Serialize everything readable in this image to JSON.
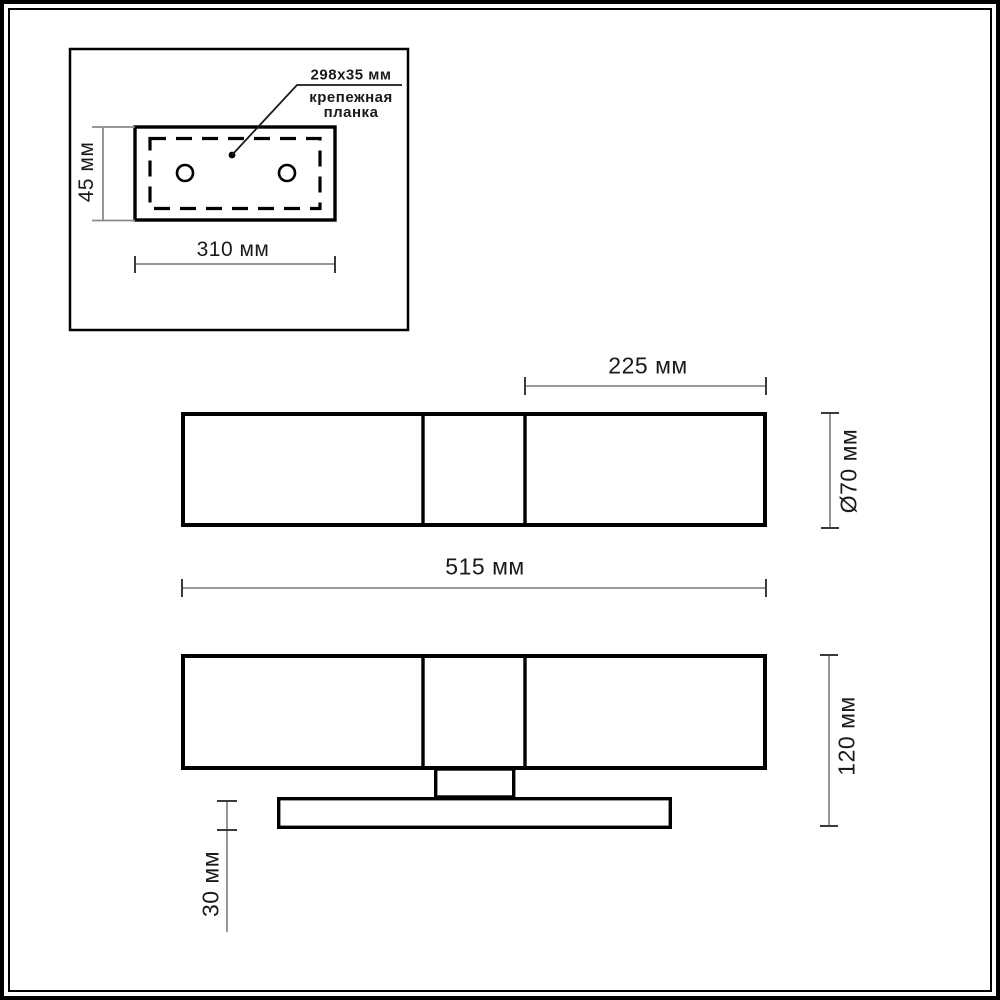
{
  "inset": {
    "plate_size_label": "298x35 мм",
    "plate_name_line1": "крепежная",
    "plate_name_line2": "планка",
    "dim_height": "45 мм",
    "dim_width": "310 мм"
  },
  "front_view": {
    "dim_right_section": "225 мм",
    "dim_diameter": "Ø70 мм",
    "dim_total_width": "515 мм"
  },
  "side_view": {
    "dim_height": "120 мм",
    "dim_base_height": "30 мм"
  },
  "colors": {
    "outline": "#000000",
    "dim_line": "#8a8a8a",
    "dim_tick": "#3a3a3a",
    "text": "#1a1a1a",
    "background": "#ffffff"
  }
}
